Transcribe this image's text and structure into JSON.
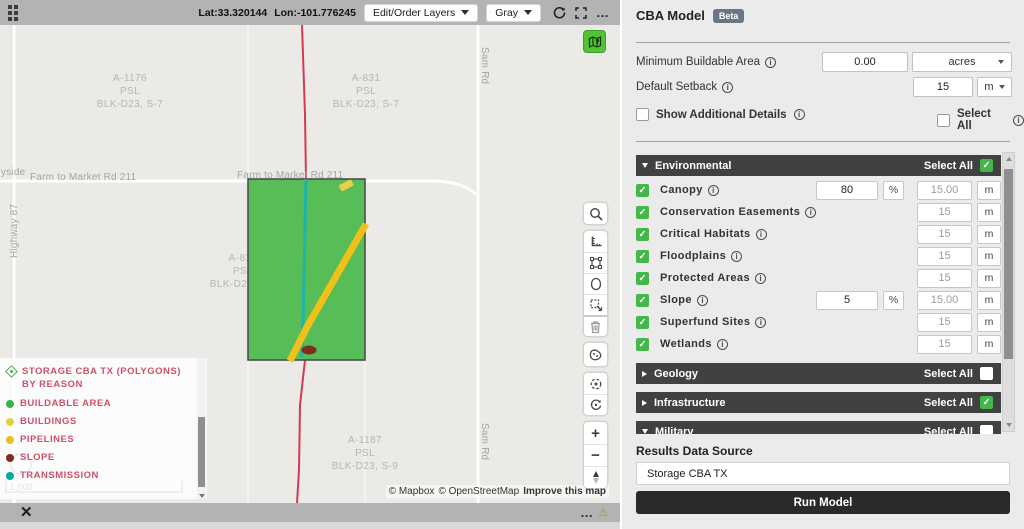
{
  "topbar": {
    "lat": "Lat:33.320144",
    "lon": "Lon:-101.776245",
    "layers_button": "Edit/Order Layers",
    "basemap_button": "Gray",
    "more_icon": "…"
  },
  "map": {
    "parcels": [
      {
        "lines": [
          "A-1176",
          "PSL",
          "BLK-D23, S-7"
        ]
      },
      {
        "lines": [
          "A-831",
          "PSL",
          "BLK-D23, S-7"
        ]
      },
      {
        "lines": [
          "A-830",
          "PSL",
          "BLK-D23, S-8"
        ]
      },
      {
        "lines": [
          "A-1187",
          "PSL",
          "BLK-D23, S-9"
        ]
      }
    ],
    "road_labels": {
      "fm211": "Farm to Market Rd 211",
      "sam_rd": "Sam Rd",
      "highway": "Highway 87",
      "partial_left": "yside"
    },
    "scale_text": "1,000",
    "feature_colors": {
      "buildable": "#56bd57",
      "buildable_border": "#4e4e4e",
      "pipeline": "#f0c11b",
      "transmission": "#1fb3ad",
      "slope": "#7e2d1f",
      "building": "#e7d04a",
      "boundary_line": "#d23b55"
    },
    "legend": {
      "title": "STORAGE CBA TX (POLYGONS) BY REASON",
      "items": [
        {
          "label": "BUILDABLE AREA",
          "color": "#3cb14b"
        },
        {
          "label": "BUILDINGS",
          "color": "#e4cf3e"
        },
        {
          "label": "PIPELINES",
          "color": "#efbd23"
        },
        {
          "label": "SLOPE",
          "color": "#7e2b20"
        },
        {
          "label": "TRANSMISSION",
          "color": "#00ac97"
        }
      ]
    },
    "attribution": {
      "mapbox": "© Mapbox",
      "osm": "© OpenStreetMap",
      "improve": "Improve this map"
    }
  },
  "bottombar": {
    "close_icon": "✕",
    "more_icon": "…",
    "warning_icon": "⚠"
  },
  "panel": {
    "title": "CBA Model",
    "beta": "Beta",
    "min_buildable": {
      "label": "Minimum Buildable Area",
      "value": "0.00",
      "unit": "acres"
    },
    "default_setback": {
      "label": "Default Setback",
      "value": "15",
      "unit": "m"
    },
    "show_additional_label": "Show Additional Details",
    "select_all_label": "Select All",
    "show_additional_checked": false,
    "top_select_all_checked": false,
    "sections": [
      {
        "label": "Environmental",
        "checked": true,
        "expanded": true
      },
      {
        "label": "Geology",
        "checked": false,
        "expanded": false
      },
      {
        "label": "Infrastructure",
        "checked": true,
        "expanded": false
      },
      {
        "label": "Military",
        "checked": false,
        "expanded": true
      }
    ],
    "env_rows": [
      {
        "label": "Canopy",
        "checked": true,
        "value": "80",
        "pct": "%",
        "setback": "15.00",
        "unit": "m"
      },
      {
        "label": "Conservation Easements",
        "checked": true,
        "setback": "15",
        "unit": "m"
      },
      {
        "label": "Critical Habitats",
        "checked": true,
        "setback": "15",
        "unit": "m"
      },
      {
        "label": "Floodplains",
        "checked": true,
        "setback": "15",
        "unit": "m"
      },
      {
        "label": "Protected Areas",
        "checked": true,
        "setback": "15",
        "unit": "m"
      },
      {
        "label": "Slope",
        "checked": true,
        "value": "5",
        "pct": "%",
        "setback": "15.00",
        "unit": "m"
      },
      {
        "label": "Superfund Sites",
        "checked": true,
        "setback": "15",
        "unit": "m"
      },
      {
        "label": "Wetlands",
        "checked": true,
        "setback": "15",
        "unit": "m"
      }
    ],
    "results_label": "Results Data Source",
    "results_value": "Storage CBA TX",
    "run_button": "Run Model"
  }
}
